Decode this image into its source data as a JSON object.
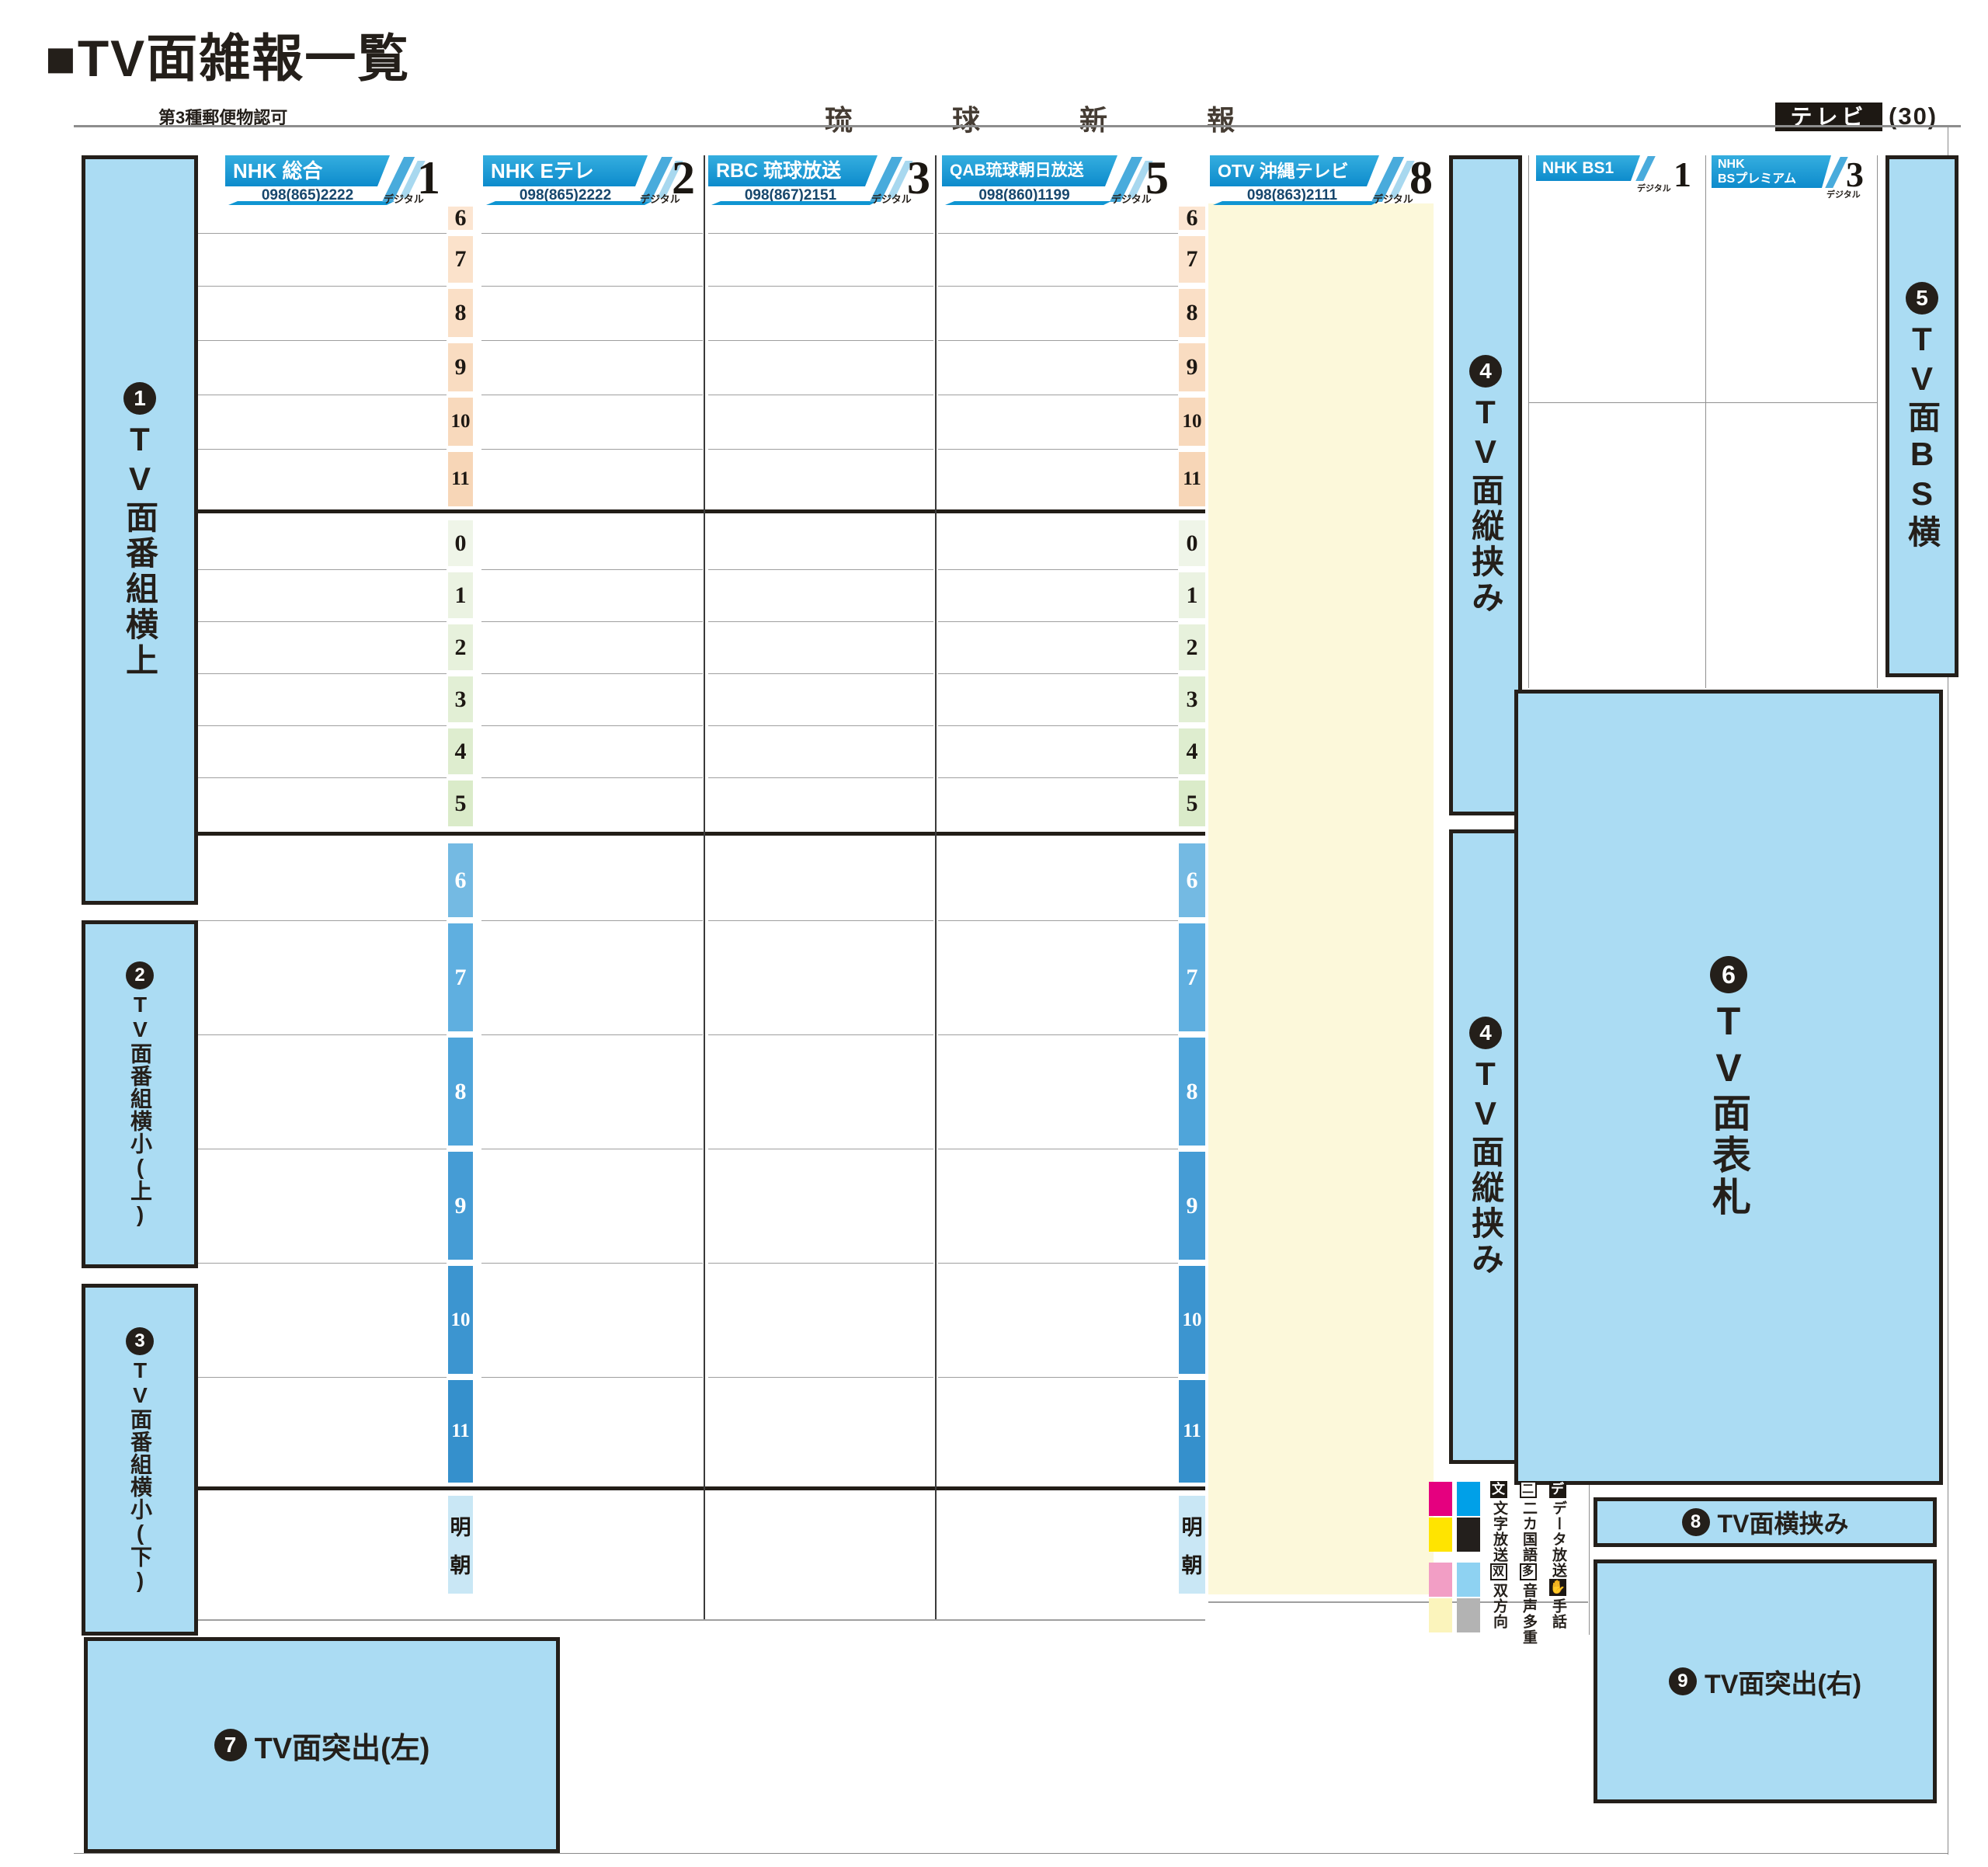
{
  "header": {
    "title": "■TV面雑報一覧",
    "permit": "第3種郵便物認可",
    "paper_name": "琉球新報",
    "section_badge": "テレビ",
    "page_number": "(30)"
  },
  "channels": [
    {
      "name": "NHK 総合",
      "phone": "098(865)2222",
      "digital_label": "デジタル",
      "number": "1"
    },
    {
      "name": "NHK Eテレ",
      "phone": "098(865)2222",
      "digital_label": "デジタル",
      "number": "2"
    },
    {
      "name": "RBC 琉球放送",
      "phone": "098(867)2151",
      "digital_label": "デジタル",
      "number": "3"
    },
    {
      "name": "QAB琉球朝日放送",
      "phone": "098(860)1199",
      "digital_label": "デジタル",
      "number": "5"
    },
    {
      "name": "OTV 沖縄テレビ",
      "phone": "098(863)2111",
      "digital_label": "デジタル",
      "number": "8"
    }
  ],
  "bs_channels": [
    {
      "name": "NHK BS1",
      "digital_label": "デジタル",
      "number": "1"
    },
    {
      "name_line1": "NHK",
      "name_line2": "BSプレミアム",
      "digital_label": "デジタル",
      "number": "3"
    }
  ],
  "timeline": {
    "morning": {
      "labels": [
        "6",
        "7",
        "8",
        "9",
        "10",
        "11"
      ],
      "bg": [
        "#fce5d1",
        "#fbe2cb",
        "#fadfc6",
        "#f9dcc1",
        "#f8d9bc",
        "#f7d6b7"
      ],
      "fg": "#1d1813"
    },
    "afternoon": {
      "labels": [
        "0",
        "1",
        "2",
        "3",
        "4",
        "5"
      ],
      "bg": [
        "#eff5e8",
        "#ebf3e2",
        "#e7f1dc",
        "#e2efd5",
        "#deedcf",
        "#daebc9"
      ],
      "fg": "#1d1813"
    },
    "evening": {
      "labels": [
        "6",
        "7",
        "8",
        "9",
        "10",
        "11"
      ],
      "bg": [
        "#74bae3",
        "#5fafe0",
        "#4fa5da",
        "#459cd5",
        "#3c95d0",
        "#3590cc"
      ],
      "fg": "#ffffff"
    },
    "overnight": {
      "label": "明朝",
      "bg": "#c9e7f5",
      "fg": "#1d1813"
    }
  },
  "boxes": {
    "box1": {
      "badge": "1",
      "label": "TV面番組横上"
    },
    "box2": {
      "badge": "2",
      "label": "TV面番組横小(上)"
    },
    "box3": {
      "badge": "3",
      "label": "TV面番組横小(下)"
    },
    "box4a": {
      "badge": "4",
      "label": "TV面縦挟み"
    },
    "box4b": {
      "badge": "4",
      "label": "TV面縦挟み"
    },
    "box5": {
      "badge": "5",
      "label": "TV面BS横"
    },
    "box6": {
      "badge": "6",
      "label": "TV面表札"
    },
    "box7": {
      "badge": "7",
      "label": "TV面突出(左)"
    },
    "box8": {
      "badge": "8",
      "label": "TV面横挟み"
    },
    "box9": {
      "badge": "9",
      "label": "TV面突出(右)"
    }
  },
  "legend": {
    "swatch_colors": [
      "#e5007f",
      "#00a0e8",
      "#ffe400",
      "#231f1c",
      "#f29ec5",
      "#8ed2f2",
      "#fbf4bc",
      "#b3b3b3"
    ],
    "columns": [
      {
        "head": "デ",
        "text1": "データ放送",
        "icon": "✋",
        "text2": "手話"
      },
      {
        "head": "二",
        "text1": "二カ国語",
        "icon": "多",
        "text2": "音声多重"
      },
      {
        "head": "文",
        "text1": "文字放送",
        "icon": "双",
        "text2": "双方向"
      }
    ]
  },
  "colors": {
    "box_fill": "#abdcf3",
    "banner_blue": "#1095d2",
    "otv_column_cream": "#fcf8da"
  }
}
